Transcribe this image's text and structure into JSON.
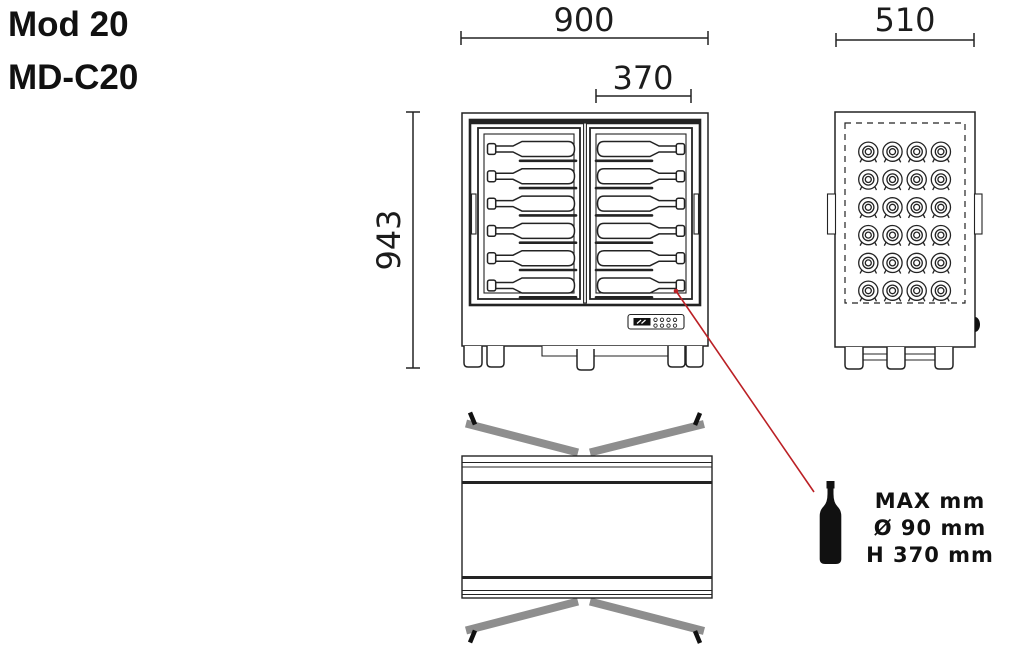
{
  "product": {
    "model": "Mod 20",
    "code": "MD-C20"
  },
  "dimensions_mm": {
    "width": "900",
    "door_opening": "370",
    "height": "943",
    "depth": "510"
  },
  "bottle_spec": {
    "line1": "MAX mm",
    "line2": "Ø 90 mm",
    "line3": "H 370 mm"
  },
  "front_view": {
    "doors": 2,
    "bottle_rows_per_door": 6
  },
  "side_view": {
    "slot_columns": 4,
    "slot_rows": 6
  },
  "colors": {
    "ink": "#232323",
    "leader_red": "#bb2025",
    "door_gray": "#8e8e8e"
  }
}
